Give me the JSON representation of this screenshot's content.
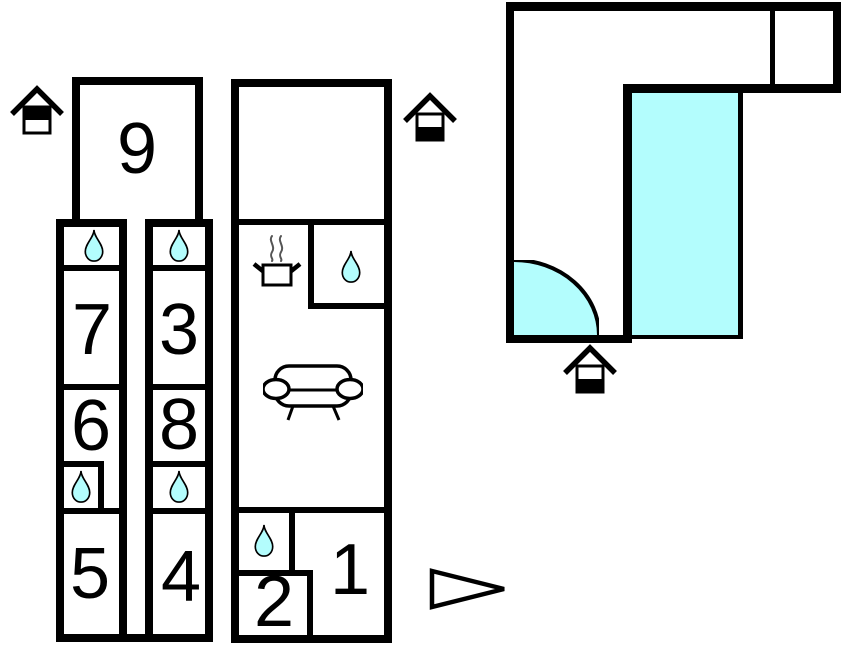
{
  "colors": {
    "wall": "#000000",
    "background": "#ffffff",
    "water-fill": "#b3fdfd",
    "steam": "#555555"
  },
  "rooms": {
    "room1": "1",
    "room2": "2",
    "room3": "3",
    "room4": "4",
    "room5": "5",
    "room6": "6",
    "room7": "7",
    "room8": "8",
    "room9": "9"
  },
  "icons": {
    "entrance_upper_floor": "house-entrance-icon (upper half filled)",
    "entrance_ground_floor": "house-entrance-icon (lower half filled)",
    "water_drop": "water-drop-icon (bath/shower)",
    "cooking_pot": "cooking-pot-with-steam-icon (kitchen)",
    "sofa": "sofa-icon (living room)",
    "door_swing": "door-swing-quarter-arc",
    "direction_arrow": "right-pointing-triangle"
  }
}
